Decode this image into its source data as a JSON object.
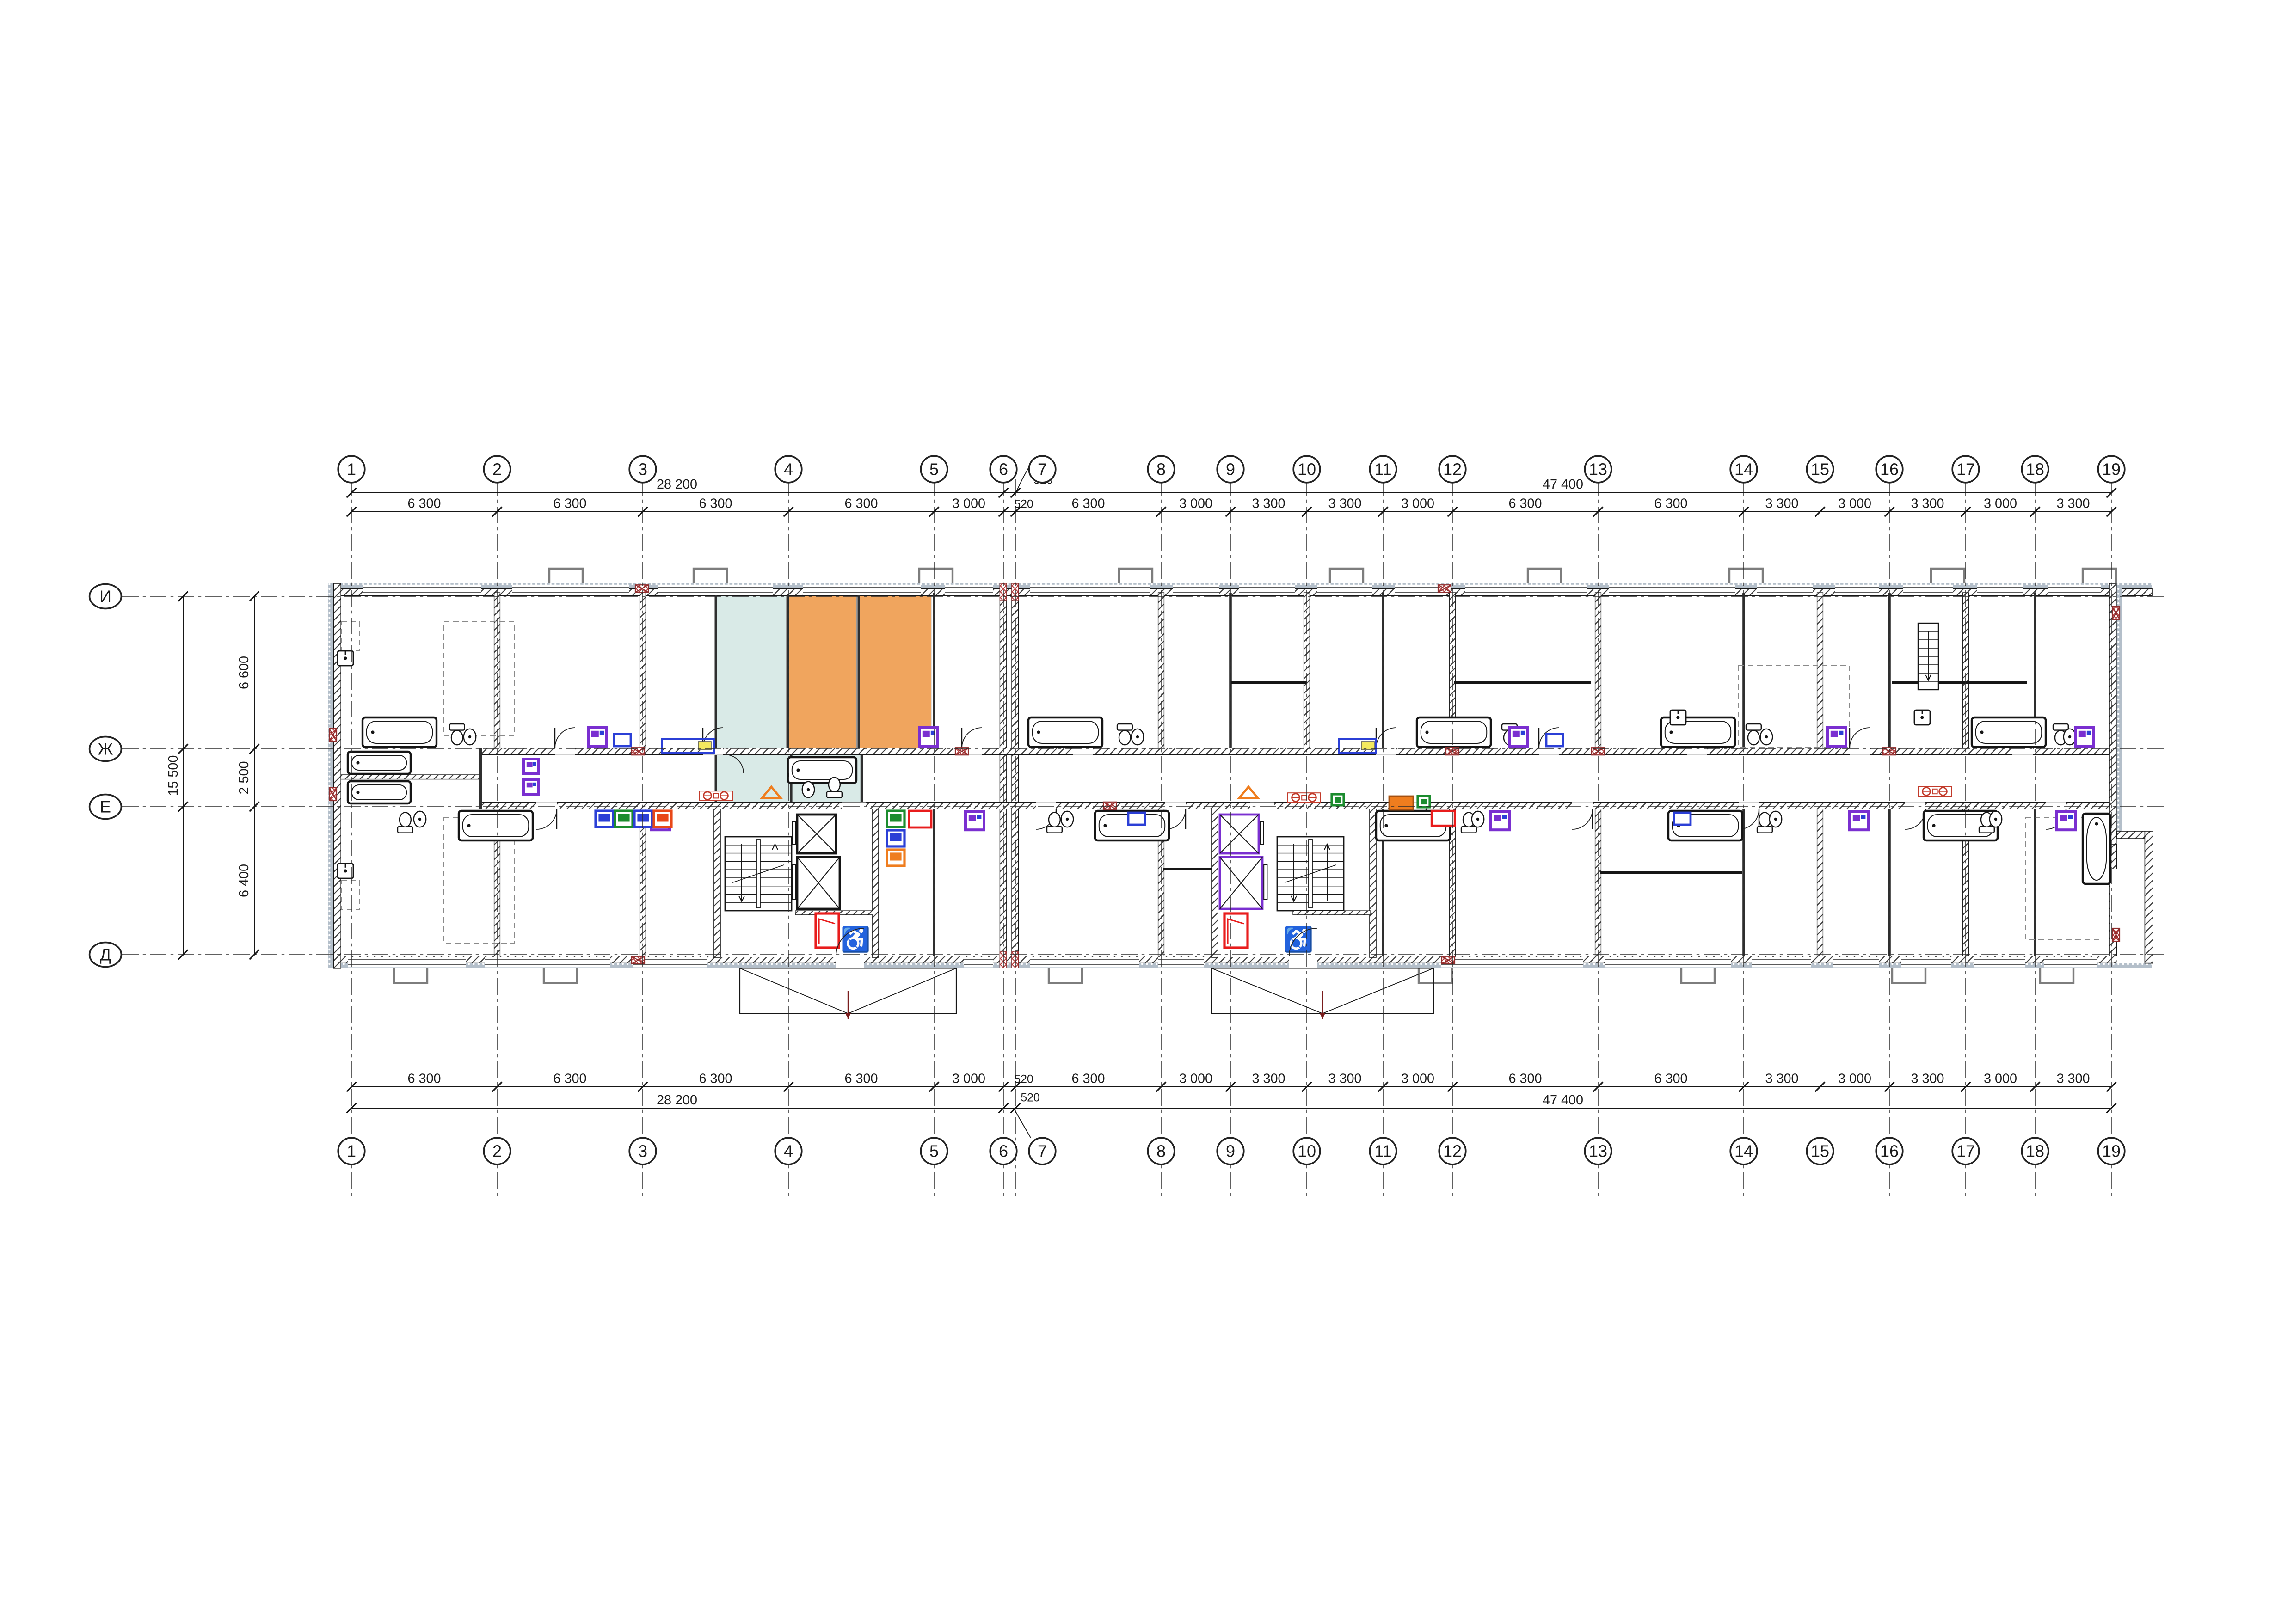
{
  "drawing": {
    "kind": "residential-floor-plan",
    "grid": {
      "column_labels": [
        "1",
        "2",
        "3",
        "4",
        "5",
        "6",
        "7",
        "8",
        "9",
        "10",
        "11",
        "12",
        "13",
        "14",
        "15",
        "16",
        "17",
        "18",
        "19"
      ],
      "row_labels": [
        "И",
        "Ж",
        "Е",
        "Д"
      ]
    },
    "dimensions": {
      "top": {
        "overall_left": "28 200",
        "overall_right": "47 400",
        "offset_leader": "520",
        "segments": [
          "6 300",
          "6 300",
          "6 300",
          "6 300",
          "3 000",
          "520",
          "6 300",
          "3 000",
          "3 300",
          "3 300",
          "3 000",
          "6 300",
          "6 300",
          "3 300",
          "3 000",
          "3 300",
          "3 000",
          "3 300"
        ]
      },
      "bottom": {
        "overall_left": "28 200",
        "overall_right": "47 400",
        "offset_leader": "520",
        "segments": [
          "6 300",
          "6 300",
          "6 300",
          "6 300",
          "3 000",
          "520",
          "6 300",
          "3 000",
          "3 300",
          "3 300",
          "3 000",
          "6 300",
          "6 300",
          "3 300",
          "3 000",
          "3 300",
          "3 000",
          "3 300"
        ]
      },
      "left": {
        "segments": [
          "6 600",
          "2 500",
          "6 400"
        ],
        "overall": "15 500"
      }
    },
    "symbols": {
      "accessible": "♿"
    },
    "palette": {
      "highlight_teal": "#d9eae7",
      "highlight_orange": "#f0a55e",
      "wall_dark": "#2f2f2f",
      "vent_red": "#a83434",
      "door_red": "#e81c1c",
      "washer_purple": "#7a2fd0",
      "fixture_blue": "#2b3fd6",
      "appliance_green": "#1c8c2e",
      "appliance_orange": "#ef7d1e",
      "alert_yellow": "#f3e95f",
      "stub_grey": "#7d7d7d",
      "insulation_grey": "#b4bfca"
    }
  }
}
